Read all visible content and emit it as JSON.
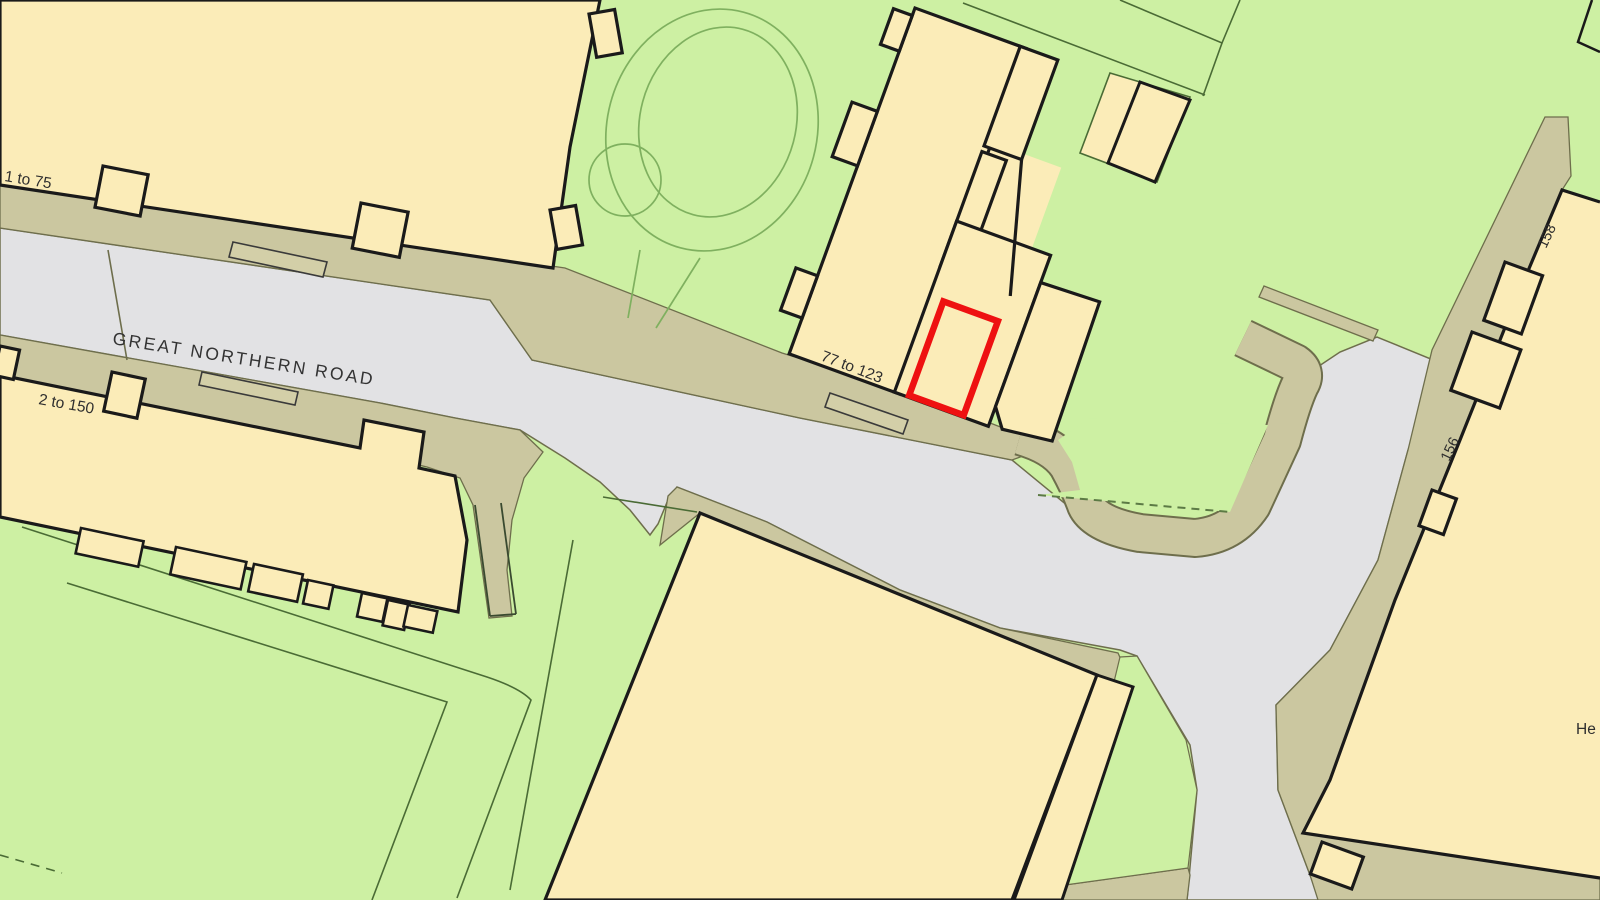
{
  "map": {
    "labels": {
      "road_name": "GREAT NORTHERN ROAD",
      "block_west": "1 to 75",
      "block_south": "2 to 150",
      "block_site": "77 to 123",
      "house_158": "158",
      "house_156": "156",
      "partial_label": "He"
    },
    "colors": {
      "green_space": "#cdf0a3",
      "building": "#fbecb8",
      "road_surface": "#e2e2e4",
      "pavement": "#cbc7a0",
      "outline_black": "#1a1a1a",
      "edge_olive": "#6e6e4c",
      "parcel_line": "#4a6b35",
      "tree_line": "#7fb05f",
      "site_boundary_red": "#ee1111"
    }
  }
}
